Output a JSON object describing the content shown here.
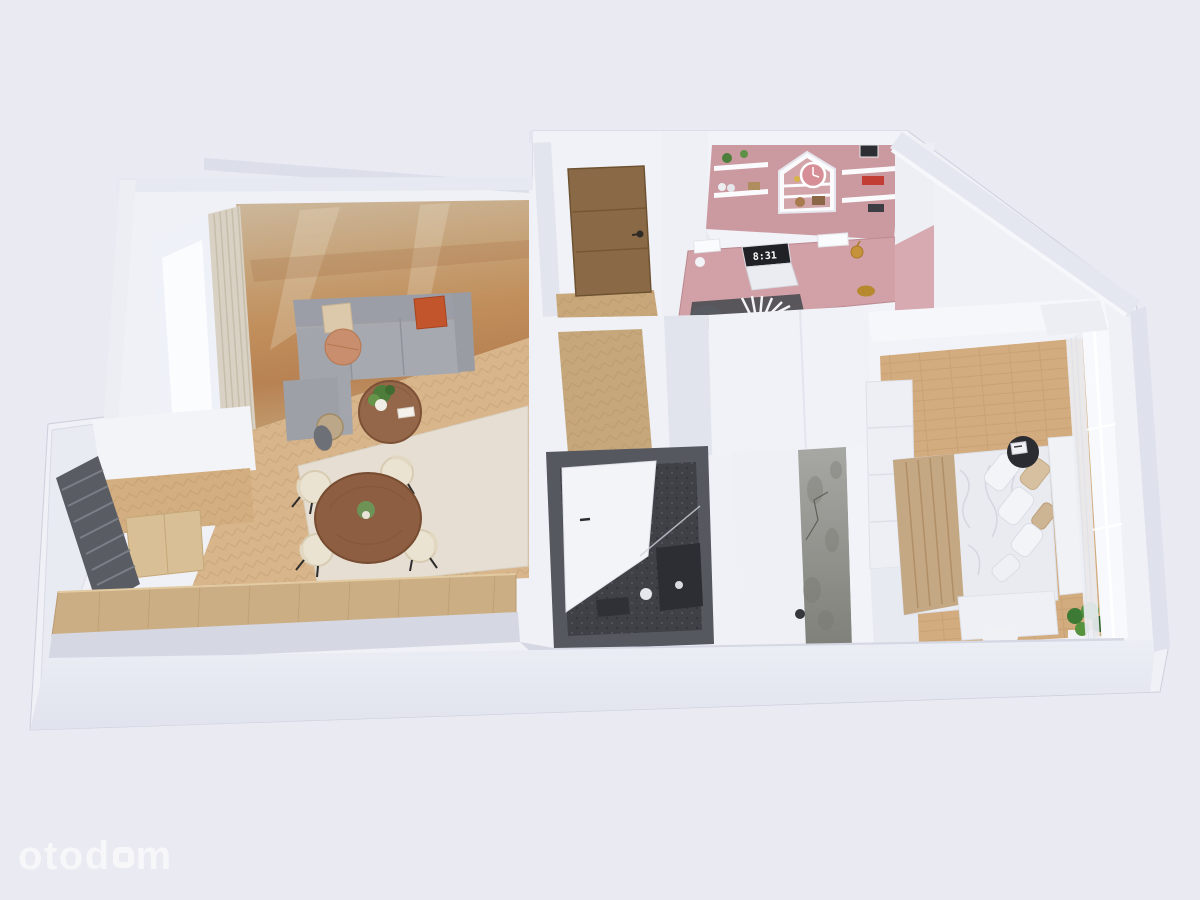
{
  "watermark": {
    "brand": "otodom",
    "part1": "otod",
    "part2": "m"
  },
  "office": {
    "laptop_time": "8:31"
  },
  "colors": {
    "background": "#e9eaf2",
    "watermark_color": "#f7f7fa",
    "wall_white": "#f1f2f7",
    "wall_shadow": "#dfe2ec",
    "floor_wood": "#d8b58a",
    "floor_wood_dark": "#c8a87b",
    "rust_wall": "#c18f5c",
    "office_pink": "#cb9aa1",
    "desk_pink": "#d1a1a7",
    "bathroom_dark": "#3f4147",
    "sofa_gray": "#a3a5ac",
    "pillow_orange": "#c2552c",
    "cushion_terracotta": "#c98e6d",
    "door_brown": "#8a6a46",
    "table_walnut": "#8d5e41",
    "chair_cream": "#ebe3d2",
    "radiator_gray": "#595c63",
    "concrete_gray": "#8f908a",
    "blanket_beige": "#c4a783",
    "plant_green": "#4c8040"
  },
  "scene": {
    "type": "3d-floor-plan-render",
    "rooms": [
      {
        "name": "living-room",
        "items": [
          "corner sofa",
          "ottoman",
          "coffee table",
          "round dining table",
          "four chairs",
          "rug",
          "curtains",
          "copper accent wall"
        ]
      },
      {
        "name": "kitchen-area",
        "items": [
          "wood counter",
          "radiator",
          "cabinet"
        ]
      },
      {
        "name": "entrance-hall",
        "items": [
          "wooden entrance door"
        ]
      },
      {
        "name": "home-office",
        "items": [
          "pink walls",
          "desk",
          "laptop",
          "house shelf",
          "wall clock",
          "desk lamp",
          "chair"
        ]
      },
      {
        "name": "corridor",
        "items": [
          "herringbone floor"
        ]
      },
      {
        "name": "bathroom",
        "items": [
          "dark tiles",
          "white door",
          "shower",
          "vanity"
        ]
      },
      {
        "name": "dressing-room",
        "items": [
          "concrete accent wall"
        ]
      },
      {
        "name": "bedroom",
        "items": [
          "double bed",
          "nightstand",
          "alarm clock",
          "wardrobe",
          "bench",
          "plant",
          "window"
        ]
      },
      {
        "name": "balcony",
        "items": []
      }
    ]
  }
}
